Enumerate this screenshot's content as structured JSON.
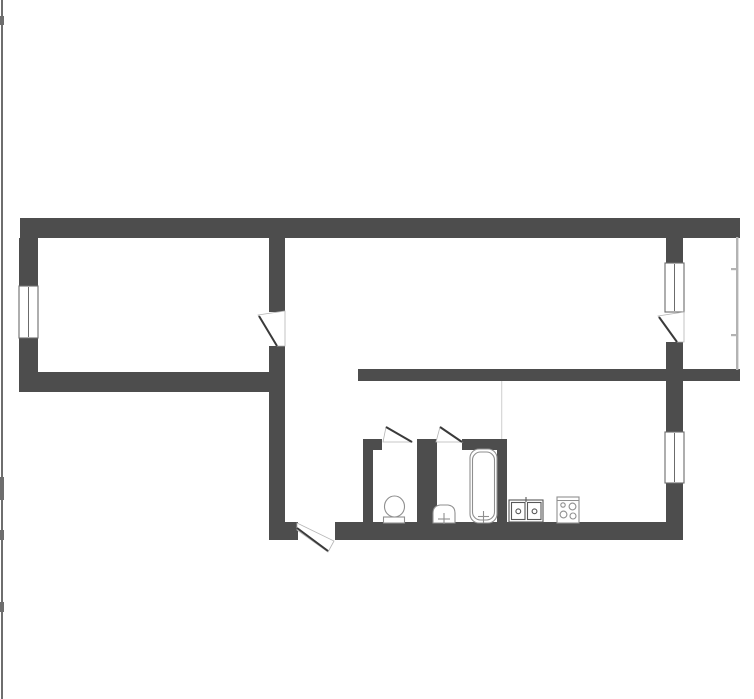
{
  "meta": {
    "description": "apartment-floor-plan",
    "canvas": {
      "width": 754,
      "height": 699
    },
    "background": "#ffffff"
  },
  "palette": {
    "wall": "#4d4d4d",
    "door_leaf": "#3a3a3a",
    "door_flap_outline": "#b5b5b5",
    "window_border": "#6b6b6b",
    "window_fill": "#ffffff",
    "fixture_light": "#8f8f8f",
    "fixture_dark": "#585858",
    "thin_line": "#b3b3b3",
    "faint_line": "#d9d9d9",
    "edge_artifact": "#6e6e6e",
    "opening_fill": "#ffffff"
  },
  "walls": [
    {
      "id": "outer-top-wall",
      "x": 20,
      "y": 218,
      "w": 720,
      "h": 20
    },
    {
      "id": "outer-left-wall-upper",
      "x": 19,
      "y": 238,
      "w": 19,
      "h": 48
    },
    {
      "id": "outer-left-wall-lower",
      "x": 19,
      "y": 338,
      "w": 19,
      "h": 54
    },
    {
      "id": "left-room-bottom-wall",
      "x": 19,
      "y": 372,
      "w": 266,
      "h": 20
    },
    {
      "id": "left-middle-divider-upper",
      "x": 269,
      "y": 238,
      "w": 16,
      "h": 74
    },
    {
      "id": "left-middle-divider-lower",
      "x": 269,
      "y": 346,
      "w": 16,
      "h": 194
    },
    {
      "id": "hall-bottom-wall-foot",
      "x": 269,
      "y": 522,
      "w": 29,
      "h": 18
    },
    {
      "id": "middle-horizontal-wall",
      "x": 358,
      "y": 369,
      "w": 382,
      "h": 12
    },
    {
      "id": "balcony-partition-upper",
      "x": 666,
      "y": 238,
      "w": 17,
      "h": 25
    },
    {
      "id": "balcony-partition-lower",
      "x": 666,
      "y": 342,
      "w": 17,
      "h": 27
    },
    {
      "id": "kitchen-right-wall-upper",
      "x": 666,
      "y": 381,
      "w": 17,
      "h": 51
    },
    {
      "id": "kitchen-right-wall-lower",
      "x": 666,
      "y": 483,
      "w": 17,
      "h": 57
    },
    {
      "id": "bottom-wall-main",
      "x": 335,
      "y": 522,
      "w": 348,
      "h": 18
    },
    {
      "id": "wc-left-wall",
      "x": 363,
      "y": 439,
      "w": 10,
      "h": 84
    },
    {
      "id": "wc-top-stub",
      "x": 363,
      "y": 439,
      "w": 19,
      "h": 11
    },
    {
      "id": "wc-bath-divider-wall",
      "x": 417,
      "y": 439,
      "w": 20,
      "h": 84
    },
    {
      "id": "bath-top-stub",
      "x": 462,
      "y": 439,
      "w": 45,
      "h": 11
    },
    {
      "id": "bath-right-wall",
      "x": 497,
      "y": 446,
      "w": 10,
      "h": 77
    }
  ],
  "windows": [
    {
      "id": "left-room-window",
      "x": 19,
      "y": 286,
      "w": 19,
      "h": 52
    },
    {
      "id": "balcony-window",
      "x": 665,
      "y": 263,
      "w": 19,
      "h": 49
    },
    {
      "id": "kitchen-window",
      "x": 665,
      "y": 432,
      "w": 19,
      "h": 51
    }
  ],
  "doors": [
    {
      "id": "left-room-door",
      "flap": "258,315 285,311 285,346 277,346",
      "leaf": [
        259,
        316,
        277,
        346
      ]
    },
    {
      "id": "balcony-door",
      "flap": "658,316 684,312 684,342 677,342",
      "leaf": [
        659,
        317,
        677,
        342
      ]
    },
    {
      "id": "wc-door",
      "flap": "383,442 386,427 412,442",
      "leaf": [
        386,
        427,
        412,
        442
      ]
    },
    {
      "id": "bath-door",
      "flap": "436,442 440,427 462,442",
      "leaf": [
        440,
        427,
        462,
        442
      ]
    },
    {
      "id": "entrance-door",
      "flap": "297,523 334,541 328,552 297,530",
      "leaf": [
        297,
        528,
        328,
        551
      ]
    }
  ],
  "thin_lines": [
    {
      "id": "balcony-outer-line",
      "x": 736,
      "y": 237,
      "w": 2.4,
      "h": 133,
      "color": "thin_line"
    },
    {
      "id": "balcony-tick-upper",
      "x": 731,
      "y": 268,
      "w": 6,
      "h": 2.2,
      "color": "thin_line"
    },
    {
      "id": "balcony-tick-lower",
      "x": 731,
      "y": 334,
      "w": 6,
      "h": 2.2,
      "color": "thin_line"
    },
    {
      "id": "kitchen-hall-boundary-line",
      "x": 501,
      "y": 381,
      "w": 1.3,
      "h": 58,
      "color": "faint_line"
    },
    {
      "id": "page-edge-line",
      "x": 1,
      "y": 0,
      "w": 2,
      "h": 699,
      "color": "edge_artifact"
    },
    {
      "id": "page-edge-tick-1",
      "x": 0,
      "y": 16,
      "w": 4,
      "h": 9,
      "color": "edge_artifact"
    },
    {
      "id": "page-edge-tick-2",
      "x": 0,
      "y": 477,
      "w": 4,
      "h": 23,
      "color": "edge_artifact"
    },
    {
      "id": "page-edge-tick-3",
      "x": 0,
      "y": 530,
      "w": 4,
      "h": 10,
      "color": "edge_artifact"
    },
    {
      "id": "page-edge-tick-4",
      "x": 0,
      "y": 602,
      "w": 4,
      "h": 10,
      "color": "edge_artifact"
    }
  ],
  "fixtures": [
    {
      "id": "toilet-fixture",
      "parts": [
        {
          "t": "rect",
          "x": 383.5,
          "y": 517,
          "w": 21,
          "h": 6,
          "stroke": "fixture_light",
          "fill": "#ffffff"
        },
        {
          "t": "ellipse",
          "cx": 394.5,
          "cy": 506.5,
          "rx": 10,
          "ry": 10.5,
          "stroke": "fixture_light",
          "fill": "#ffffff"
        }
      ]
    },
    {
      "id": "washbasin-fixture",
      "parts": [
        {
          "t": "path",
          "d": "M433 523 L433 513 Q433 506 440 505 L448 505 Q455 506 455 513 L455 523 Z",
          "stroke": "fixture_light",
          "fill": "#ffffff"
        },
        {
          "t": "line",
          "x1": 444,
          "y1": 513,
          "x2": 444,
          "y2": 524,
          "stroke": "fixture_light"
        },
        {
          "t": "line",
          "x1": 438,
          "y1": 519,
          "x2": 450,
          "y2": 519,
          "stroke": "fixture_light"
        }
      ]
    },
    {
      "id": "bathtub-fixture",
      "parts": [
        {
          "t": "rect",
          "x": 470,
          "y": 449,
          "w": 27,
          "h": 74,
          "rx": 9,
          "stroke": "fixture_light",
          "fill": "#ffffff"
        },
        {
          "t": "rect",
          "x": 472.5,
          "y": 452,
          "w": 22,
          "h": 68,
          "rx": 8,
          "stroke": "fixture_light",
          "fill": "none"
        },
        {
          "t": "line",
          "x1": 483.5,
          "y1": 511,
          "x2": 483.5,
          "y2": 523,
          "stroke": "fixture_light"
        },
        {
          "t": "line",
          "x1": 478,
          "y1": 516.5,
          "x2": 489,
          "y2": 516.5,
          "stroke": "fixture_light"
        }
      ]
    },
    {
      "id": "kitchen-sink-fixture",
      "parts": [
        {
          "t": "rect",
          "x": 509,
          "y": 500,
          "w": 34,
          "h": 22,
          "stroke": "fixture_dark",
          "fill": "#ffffff"
        },
        {
          "t": "rect",
          "x": 511.5,
          "y": 502.5,
          "w": 13.5,
          "h": 17,
          "stroke": "fixture_dark",
          "fill": "none"
        },
        {
          "t": "rect",
          "x": 527.5,
          "y": 502.5,
          "w": 13.5,
          "h": 17,
          "stroke": "fixture_dark",
          "fill": "none"
        },
        {
          "t": "circle",
          "cx": 518.3,
          "cy": 511.3,
          "r": 2.4,
          "stroke": "fixture_dark",
          "fill": "none"
        },
        {
          "t": "circle",
          "cx": 534.5,
          "cy": 511.3,
          "r": 2.4,
          "stroke": "fixture_dark",
          "fill": "none"
        },
        {
          "t": "line",
          "x1": 526,
          "y1": 497,
          "x2": 526,
          "y2": 502,
          "stroke": "fixture_dark"
        }
      ]
    },
    {
      "id": "stove-fixture",
      "parts": [
        {
          "t": "rect",
          "x": 557,
          "y": 497,
          "w": 22,
          "h": 26,
          "stroke": "fixture_light",
          "fill": "#ffffff"
        },
        {
          "t": "line",
          "x1": 557,
          "y1": 500.5,
          "x2": 579,
          "y2": 500.5,
          "stroke": "fixture_light"
        },
        {
          "t": "circle",
          "cx": 563,
          "cy": 505,
          "r": 2.2,
          "stroke": "fixture_light",
          "fill": "none"
        },
        {
          "t": "circle",
          "cx": 572.5,
          "cy": 506.5,
          "r": 3.4,
          "stroke": "fixture_light",
          "fill": "none"
        },
        {
          "t": "circle",
          "cx": 563.5,
          "cy": 514.5,
          "r": 3.4,
          "stroke": "fixture_light",
          "fill": "none"
        },
        {
          "t": "circle",
          "cx": 573,
          "cy": 516,
          "r": 3.0,
          "stroke": "fixture_light",
          "fill": "none"
        }
      ]
    }
  ]
}
